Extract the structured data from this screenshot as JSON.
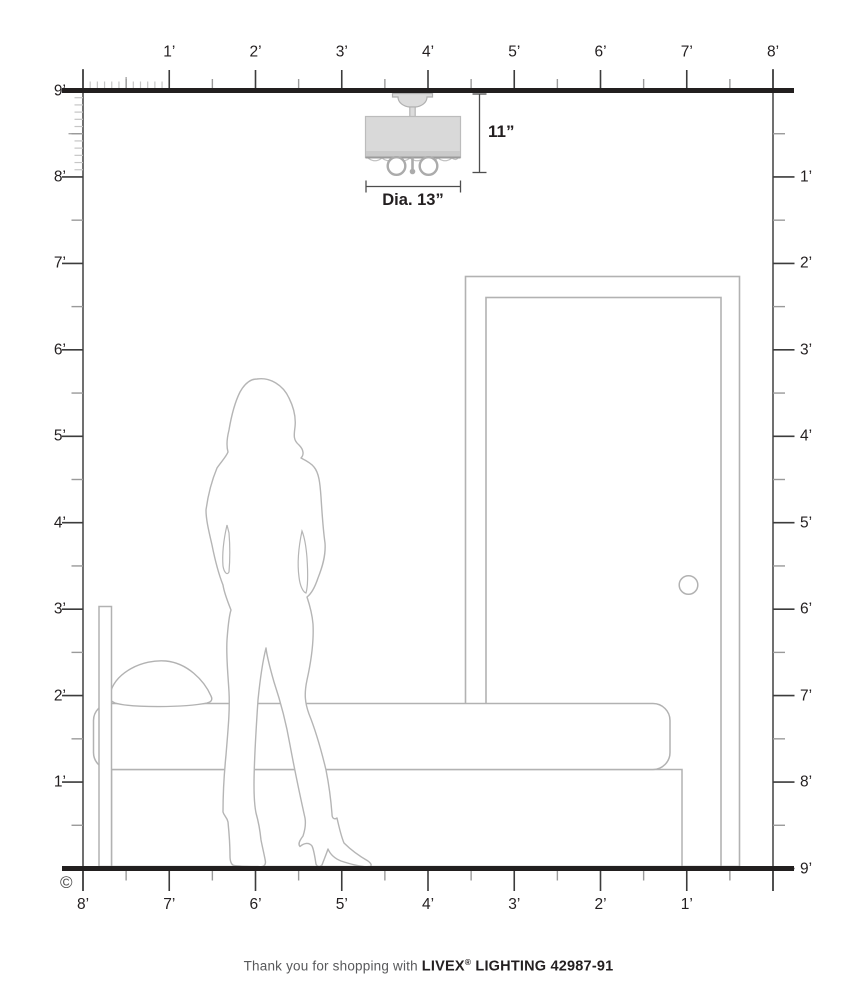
{
  "diagram": {
    "copyright_symbol": "©",
    "rulers": {
      "top": [
        "1’",
        "2’",
        "3’",
        "4’",
        "5’",
        "6’",
        "7’",
        "8’"
      ],
      "left": [
        "9’",
        "8’",
        "7’",
        "6’",
        "5’",
        "4’",
        "3’",
        "2’",
        "1’"
      ],
      "right": [
        "1’",
        "2’",
        "3’",
        "4’",
        "5’",
        "6’",
        "7’",
        "8’",
        "9’"
      ],
      "bottom": [
        "8’",
        "7’",
        "6’",
        "5’",
        "4’",
        "3’",
        "2’",
        "1’"
      ]
    },
    "fixture": {
      "height_label": "11”",
      "diameter_label": "Dia. 13”"
    },
    "colors": {
      "ink": "#231f20",
      "structure_line": "#221f1f",
      "drawing_line": "#b2b2b2",
      "tick_major": "#3c3c3c",
      "tick_minor": "#9a9a9a",
      "tick_inch": "#c6c6c6",
      "shade_fill": "#d9d9d9"
    }
  },
  "footer": {
    "prefix": "Thank you for shopping with ",
    "brand": "LIVEX",
    "registered": "®",
    "suffix": " LIGHTING 42987-91"
  }
}
